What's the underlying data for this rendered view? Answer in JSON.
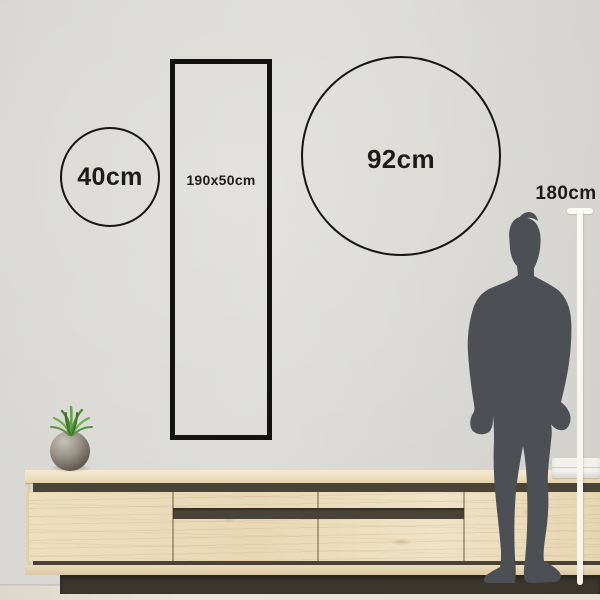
{
  "scene": {
    "title": "wall-art-size-guide",
    "wall_color": "#d8d7d3",
    "floor_color": "#e9e3d9",
    "outline_color": "#151515",
    "text_color": "#1c1c1c"
  },
  "size_options": [
    {
      "shape": "circle",
      "label": "40cm"
    },
    {
      "shape": "rectangle",
      "label": "190x50cm"
    },
    {
      "shape": "circle",
      "label": "92cm"
    }
  ],
  "person": {
    "height_label": "180cm",
    "silhouette_color": "#4c4f54",
    "ruler_color": "#fbfaf4"
  },
  "furniture": {
    "sideboard_wood_color": "#ebdcbc",
    "sideboard_trim_color": "#4a4436",
    "plinth_color": "#3a362c",
    "plant_pot_color": "#8a8378",
    "plant_leaf_color": "#67a449",
    "decor_box_color": "#f2f0ea"
  }
}
